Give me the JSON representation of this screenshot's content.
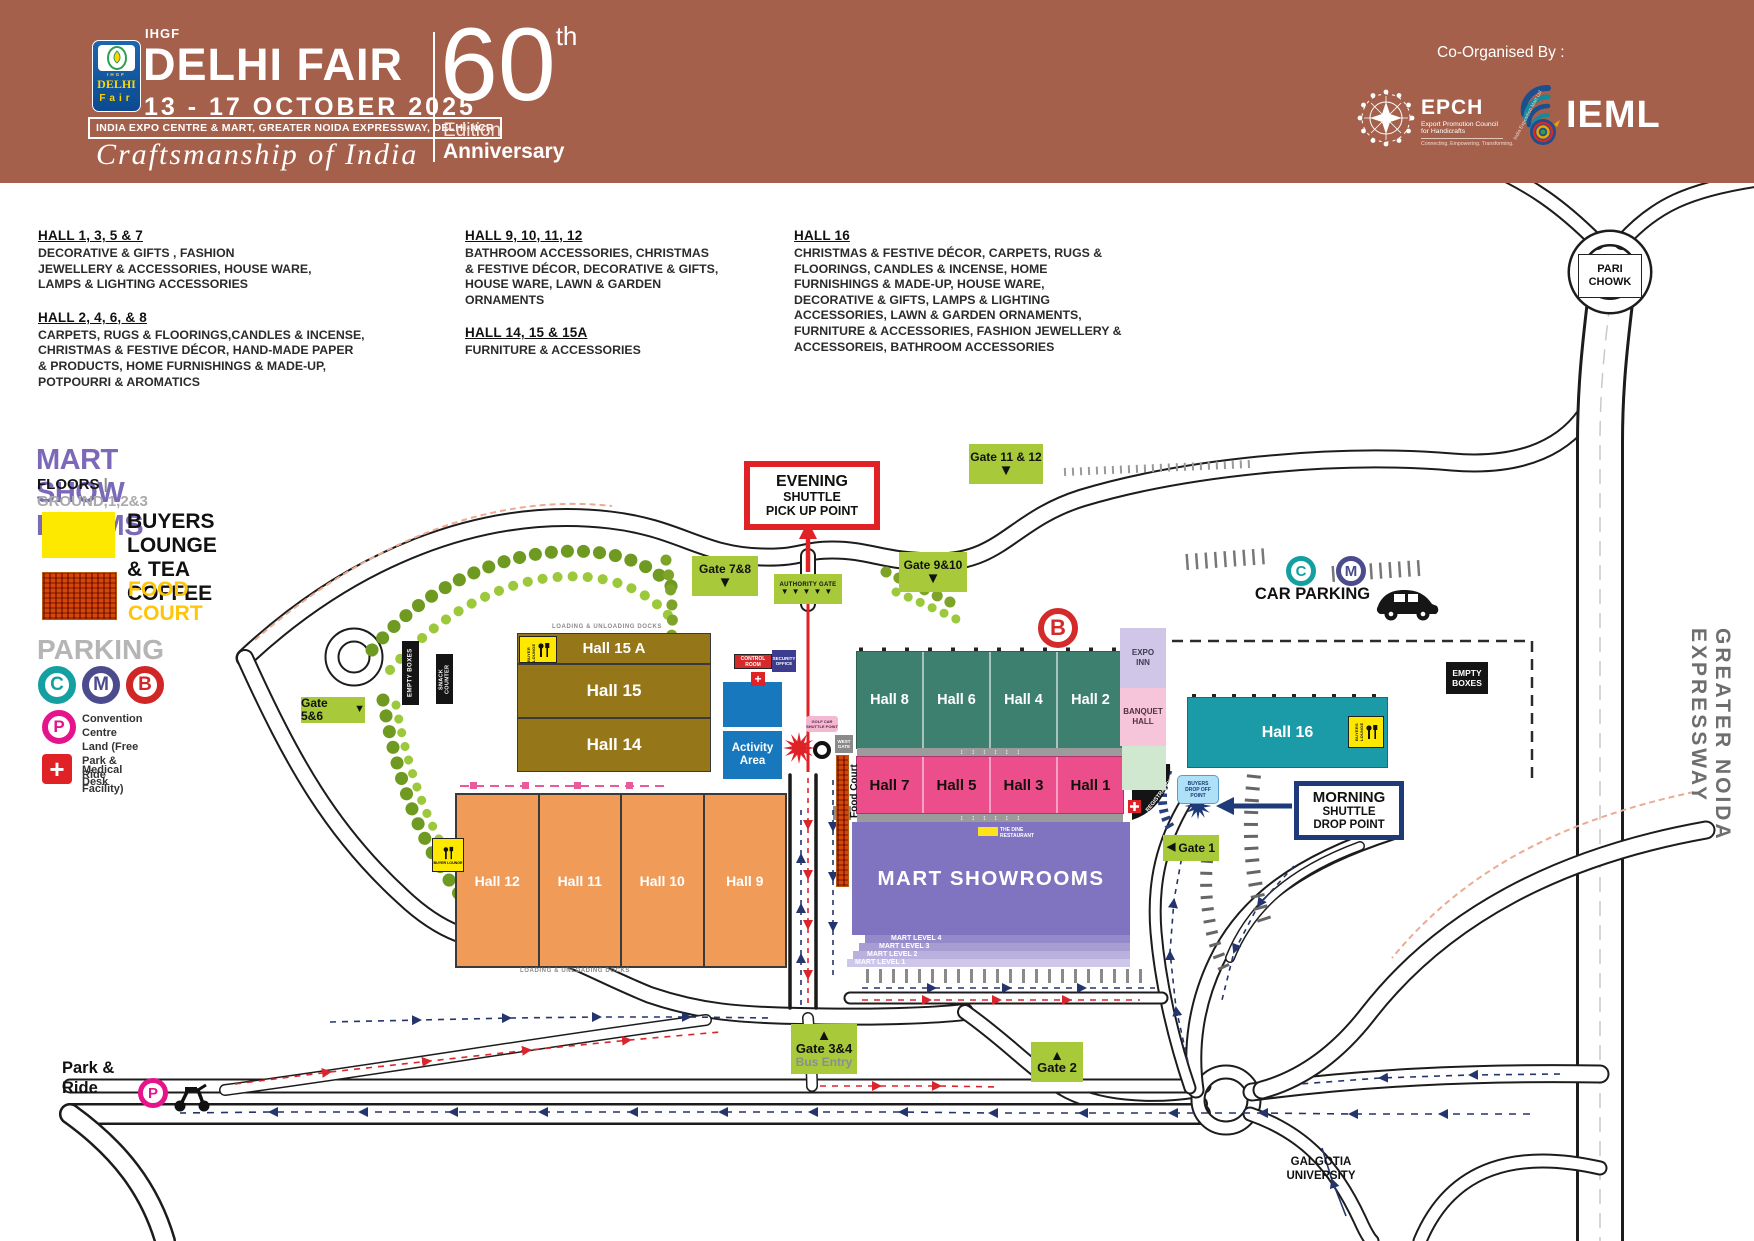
{
  "header": {
    "ihgf": "IHGF",
    "title": "DELHI FAIR",
    "dates": "13 - 17  OCTOBER  2025",
    "venue": "INDIA EXPO CENTRE & MART, GREATER NOIDA EXPRESSWAY, DELHI-NCR",
    "tagline": "Craftsmanship of India",
    "edition_number": "60",
    "edition_sup": "th",
    "edition_line1": "Edition",
    "edition_line2": "Anniversary",
    "co_organised": "Co-Organised By :",
    "logo": {
      "top": "IHGF",
      "delhi": "DELHI",
      "fair": "Fair"
    },
    "epch": {
      "name": "EPCH",
      "sub1": "Export Promotion Council",
      "sub2": "for Handicrafts",
      "tagline": "Connecting. Empowering. Transforming."
    },
    "ieml": {
      "name": "IEML",
      "ring": "India Exposition Mart Ltd"
    }
  },
  "hall_info": [
    {
      "title": "HALL 1, 3, 5 & 7",
      "body": "DECORATIVE & GIFTS , FASHION\nJEWELLERY & ACCESSORIES,  HOUSE WARE,\nLAMPS & LIGHTING ACCESSORIES"
    },
    {
      "title": "HALL 2, 4, 6, & 8",
      "body": "CARPETS, RUGS & FLOORINGS,CANDLES & INCENSE,\nCHRISTMAS & FESTIVE DÉCOR, HAND-MADE PAPER\n& PRODUCTS, HOME FURNISHINGS & MADE-UP,\nPOTPOURRI & AROMATICS"
    },
    {
      "title": "HALL 9, 10, 11, 12",
      "body": "BATHROOM ACCESSORIES, CHRISTMAS\n& FESTIVE DÉCOR, DECORATIVE & GIFTS,\nHOUSE WARE, LAWN & GARDEN\nORNAMENTS"
    },
    {
      "title": "HALL 14, 15 & 15A",
      "body": "FURNITURE & ACCESSORIES"
    },
    {
      "title": "HALL 16",
      "body": "CHRISTMAS & FESTIVE DÉCOR, CARPETS, RUGS &\nFLOORINGS, CANDLES & INCENSE, HOME\nFURNISHINGS & MADE-UP, HOUSE WARE,\nDECORATIVE & GIFTS, LAMPS & LIGHTING\nACCESSORIES, LAWN & GARDEN ORNAMENTS,\nFURNITURE  & ACCESSORIES, FASHION JEWELLERY &\nACCESSOREIS, BATHROOM ACCESSORIES"
    }
  ],
  "legend": {
    "mart_title": "MART SHOW ROOMS",
    "floors_label": "FLOORS",
    "floors_sep": "|",
    "floors_value": "GROUND,1,2&3",
    "buyers_lounge": "BUYERS LOUNGE\n& TEA COFFEE",
    "food_court": "FOOD COURT",
    "parking": "PARKING",
    "c": "C",
    "m": "M",
    "b": "B",
    "p": "P",
    "p_line1": "Convention Centre",
    "p_line2": "Land (Free Park & Ride Facility)",
    "medical": "Medical Desk"
  },
  "map": {
    "halls": {
      "h15a": "Hall 15 A",
      "h15": "Hall 15",
      "h14": "Hall 14",
      "h8": "Hall 8",
      "h6": "Hall 6",
      "h4": "Hall 4",
      "h2": "Hall 2",
      "h7": "Hall 7",
      "h5": "Hall 5",
      "h3": "Hall 3",
      "h1": "Hall 1",
      "h12": "Hall 12",
      "h11": "Hall 11",
      "h10": "Hall 10",
      "h9": "Hall 9",
      "h16": "Hall 16",
      "mart": "MART SHOWROOMS",
      "activity": "Activity Area"
    },
    "mart_levels": [
      "MART LEVEL 4",
      "MART LEVEL 3",
      "MART LEVEL 2",
      "MART LEVEL 1"
    ],
    "gates": {
      "g78": "Gate 7&8",
      "g910": "Gate 9&10",
      "g1112": "Gate 11 & 12",
      "g56": "Gate 5&6",
      "g34": "Gate 3&4",
      "g34_sub": "Bus Entry",
      "g2": "Gate 2",
      "g1": "Gate 1",
      "authority": "AUTHORITY GATE"
    },
    "shuttle": {
      "evening": [
        "EVENING",
        "SHUTTLE",
        "PICK UP POINT"
      ],
      "morning": [
        "MORNING",
        "SHUTTLE",
        "DROP POINT"
      ]
    },
    "labels": {
      "car_parking": "CAR PARKING",
      "parking_c": "C",
      "parking_m": "M",
      "parking_b": "B",
      "parking_p": "P",
      "pari_chowk": "PARI\nCHOWK",
      "expressway": "GREATER NOIDA EXPRESSWAY",
      "galgotia": "GALGOTIA\nUNIVERSITY",
      "park_ride": "Park &\nRide",
      "expo_inn": "EXPO\nINN",
      "banquet_hall": "BANQUET\nHALL",
      "empty_boxes": "EMPTY\nBOXES",
      "empty_boxes_v": "EMPTY BOXES",
      "snack_counter": "SNACK COUNTER",
      "control_room": "CONTROL ROOM",
      "security_office": "SECURITY\nOFFICE",
      "west_gate": "WEST\nGATE",
      "food_court": "Food Court",
      "buyers_drop": "BUYERS\nDROP OFF\nPOINT",
      "golf_cart": "GOLF CAR\nSHUTTLE POINT",
      "dine": "THE DINE\nRESTAURANT",
      "registration": "REGISTRATION LOBBY",
      "loading_docks": "LOADING & UNLOADING DOCKS",
      "buyer_lounge": "BUYER LOUNGE",
      "buyers_lounge": "BUYERS LOUNGE"
    }
  },
  "icons": {
    "arrow_up": "▲",
    "arrow_down": "▼",
    "arrow_left": "◀",
    "chevron_row": "▼▼▼▼▼",
    "plus": "+",
    "updown_row": "↕    ↕    ↕    ↕    ↕    ↕"
  },
  "colors": {
    "header_bg": "#a5604b",
    "hall_green": "#3e8070",
    "hall_pink": "#ec4d8b",
    "hall_orange": "#f09b57",
    "hall_gold": "#957619",
    "hall_teal": "#1b9ba8",
    "mart_purple": "#8073bf",
    "activity_blue": "#1778be",
    "gate_green": "#a8c93a",
    "accent_red": "#e02227",
    "accent_navy": "#1e3a78",
    "parking_c": "#14a0a0",
    "parking_m": "#4c4b8e",
    "parking_b": "#d02726",
    "parking_p": "#e5148c",
    "legend_purple": "#7b68b8",
    "food_gold": "#fdc60b"
  }
}
